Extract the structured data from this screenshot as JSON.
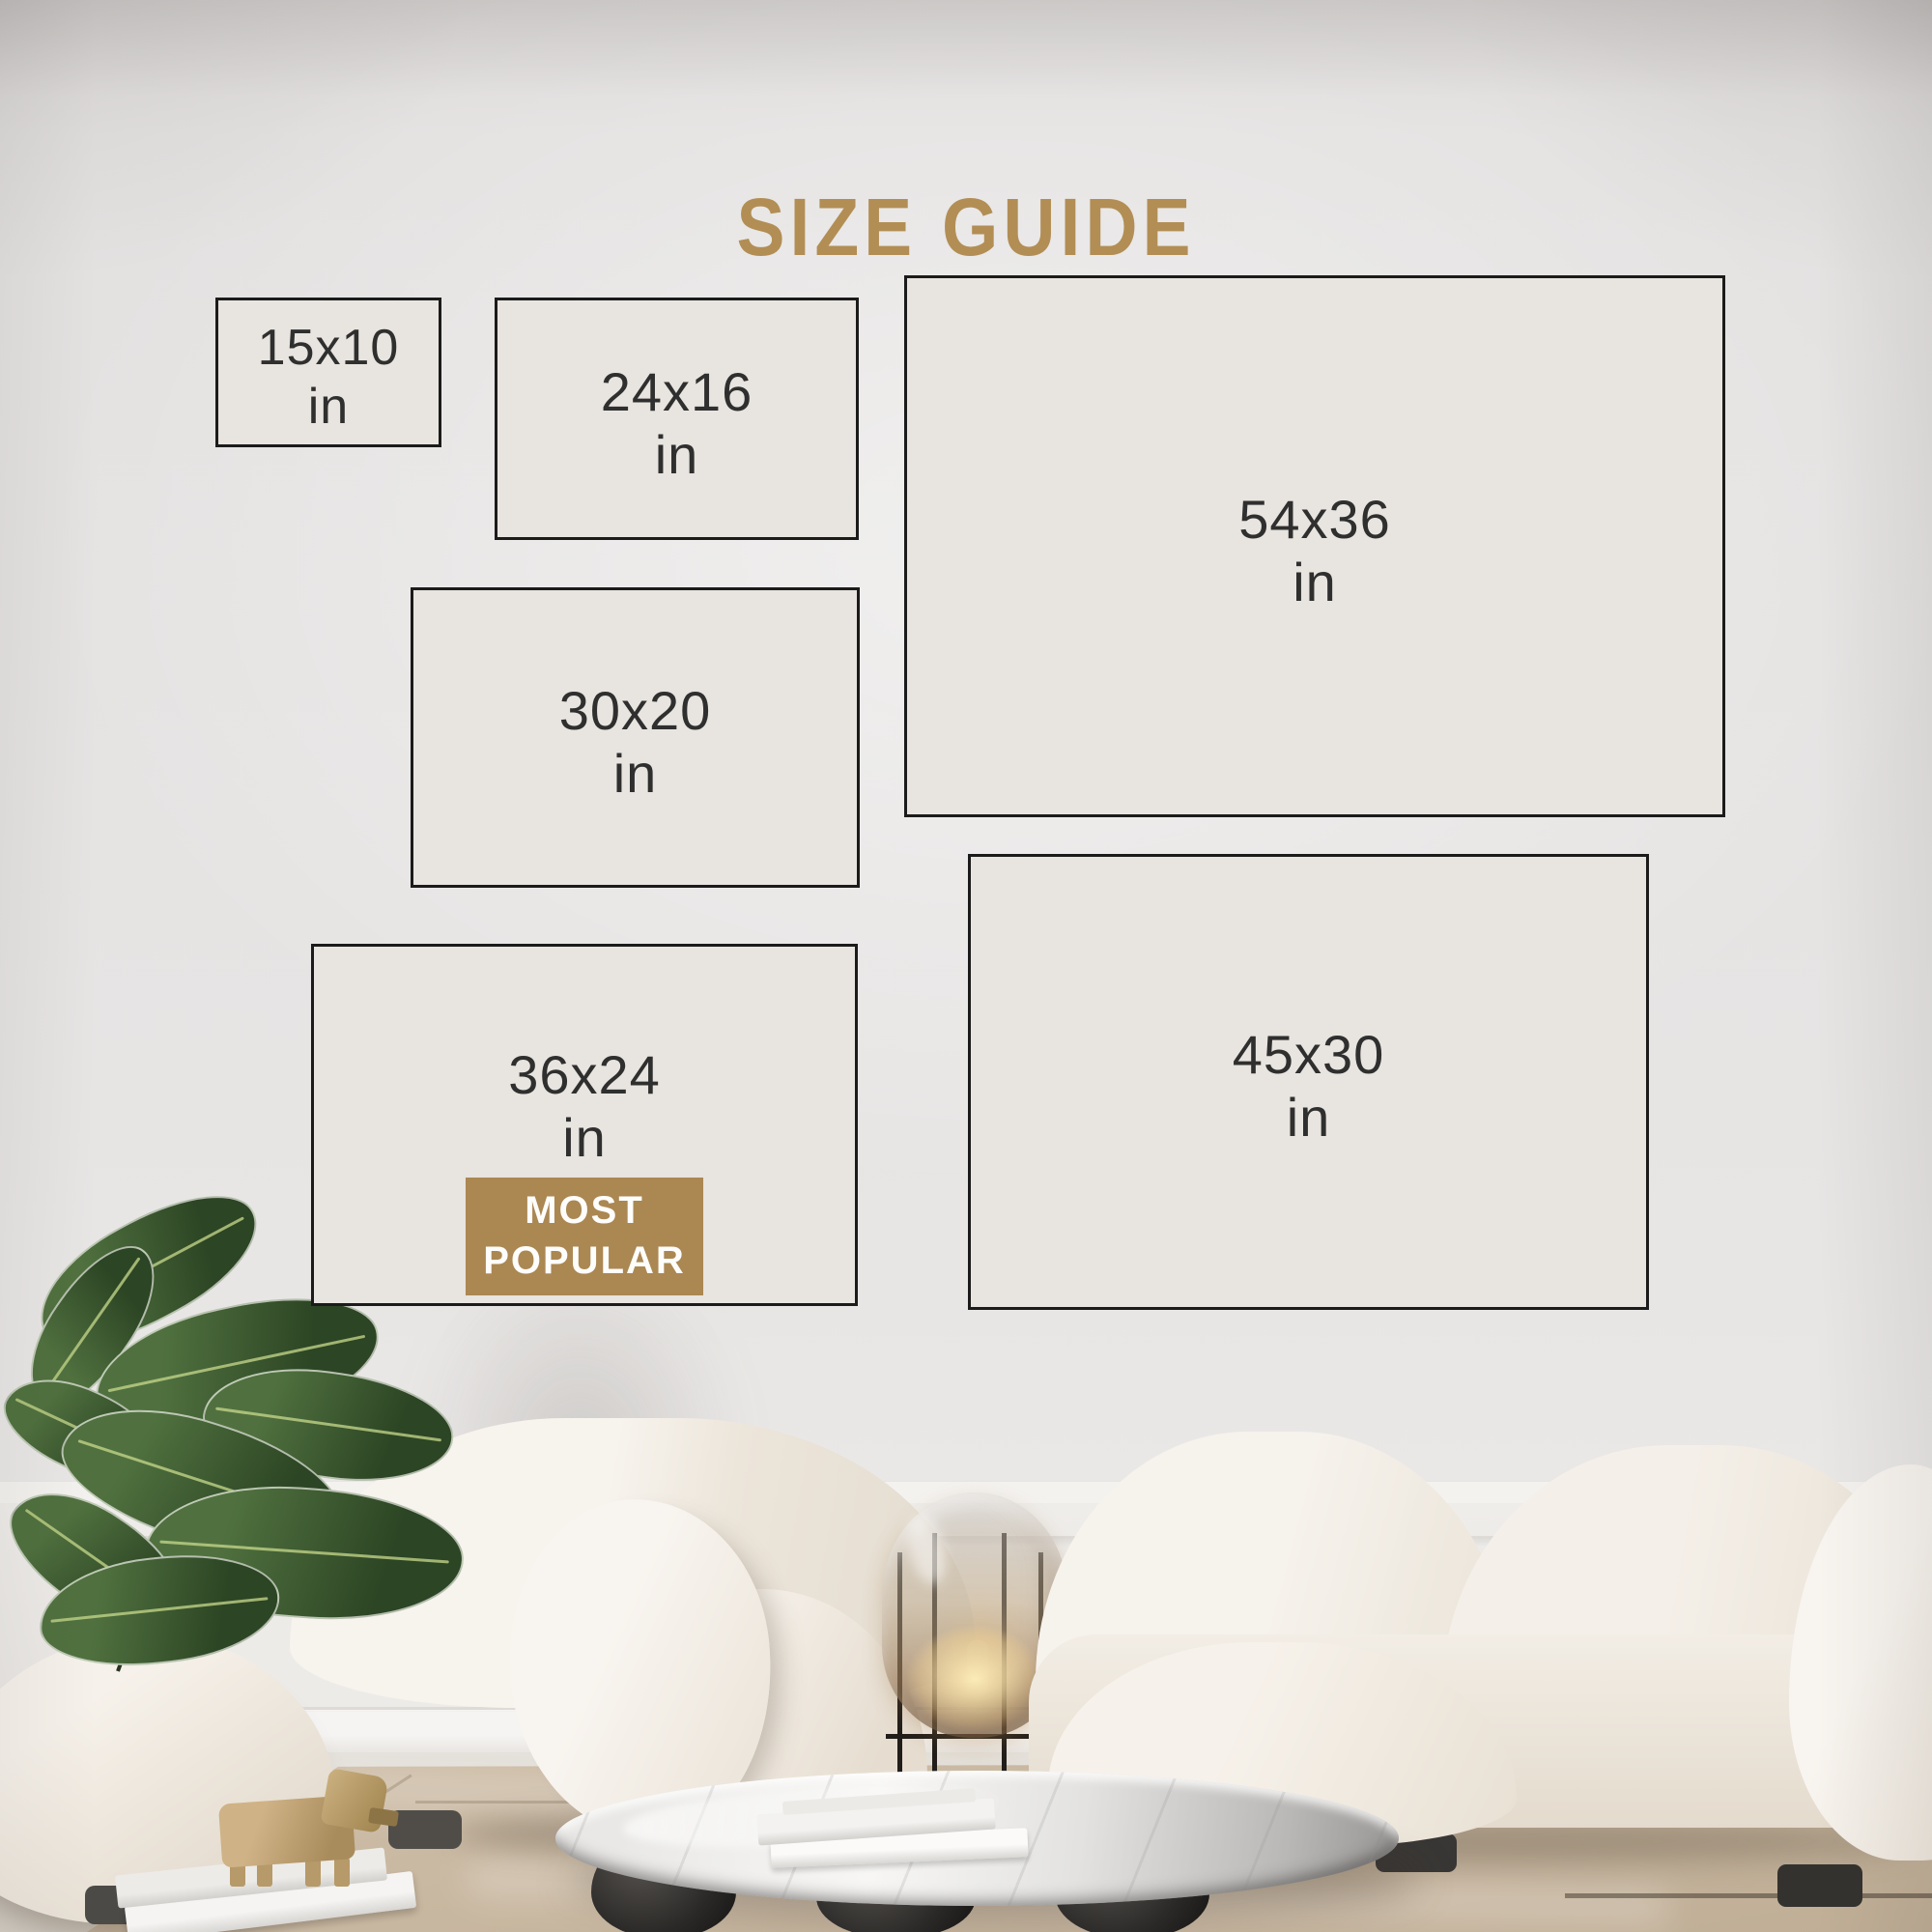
{
  "title": {
    "text": "SIZE GUIDE"
  },
  "boxes": [
    {
      "label": "15x10",
      "unit": "in",
      "most_popular": false
    },
    {
      "label": "24x16",
      "unit": "in",
      "most_popular": false
    },
    {
      "label": "54x36",
      "unit": "in",
      "most_popular": false
    },
    {
      "label": "30x20",
      "unit": "in",
      "most_popular": false
    },
    {
      "label": "36x24",
      "unit": "in",
      "most_popular": true
    },
    {
      "label": "45x30",
      "unit": "in",
      "most_popular": false
    }
  ],
  "badge": {
    "line1": "MOST",
    "line2": "POPULAR"
  },
  "accent": {
    "gold": "#b28e55",
    "badge_bg": "#ab8752",
    "badge_text_color": "#fdfdfb",
    "box_fill": "#e8e4df",
    "box_border": "#1b1b1b",
    "box_text_color": "#2f2f2f"
  }
}
